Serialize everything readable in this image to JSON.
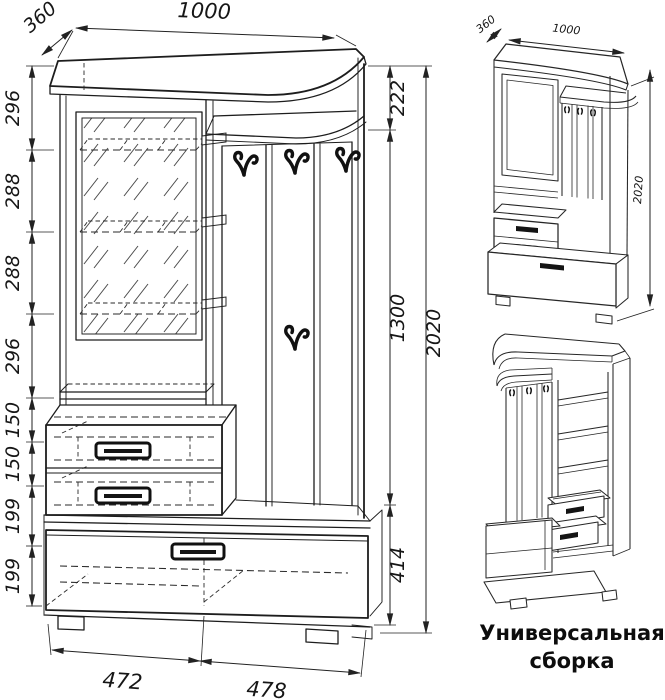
{
  "main_view": {
    "width_label": "1000",
    "depth_label": "360",
    "left_dims": [
      "296",
      "288",
      "288",
      "296",
      "150",
      "150",
      "199",
      "199"
    ],
    "right_dims": [
      "222",
      "1300",
      "414"
    ],
    "overall_height": "2020",
    "bottom_dims": [
      "472",
      "478"
    ]
  },
  "assembled_view": {
    "depth_label": "360",
    "width_label": "1000",
    "height_label": "2020"
  },
  "caption": {
    "line1": "Универсальная",
    "line2": "сборка"
  },
  "colors": {
    "line": "#1d1d1d",
    "background": "#ffffff"
  }
}
